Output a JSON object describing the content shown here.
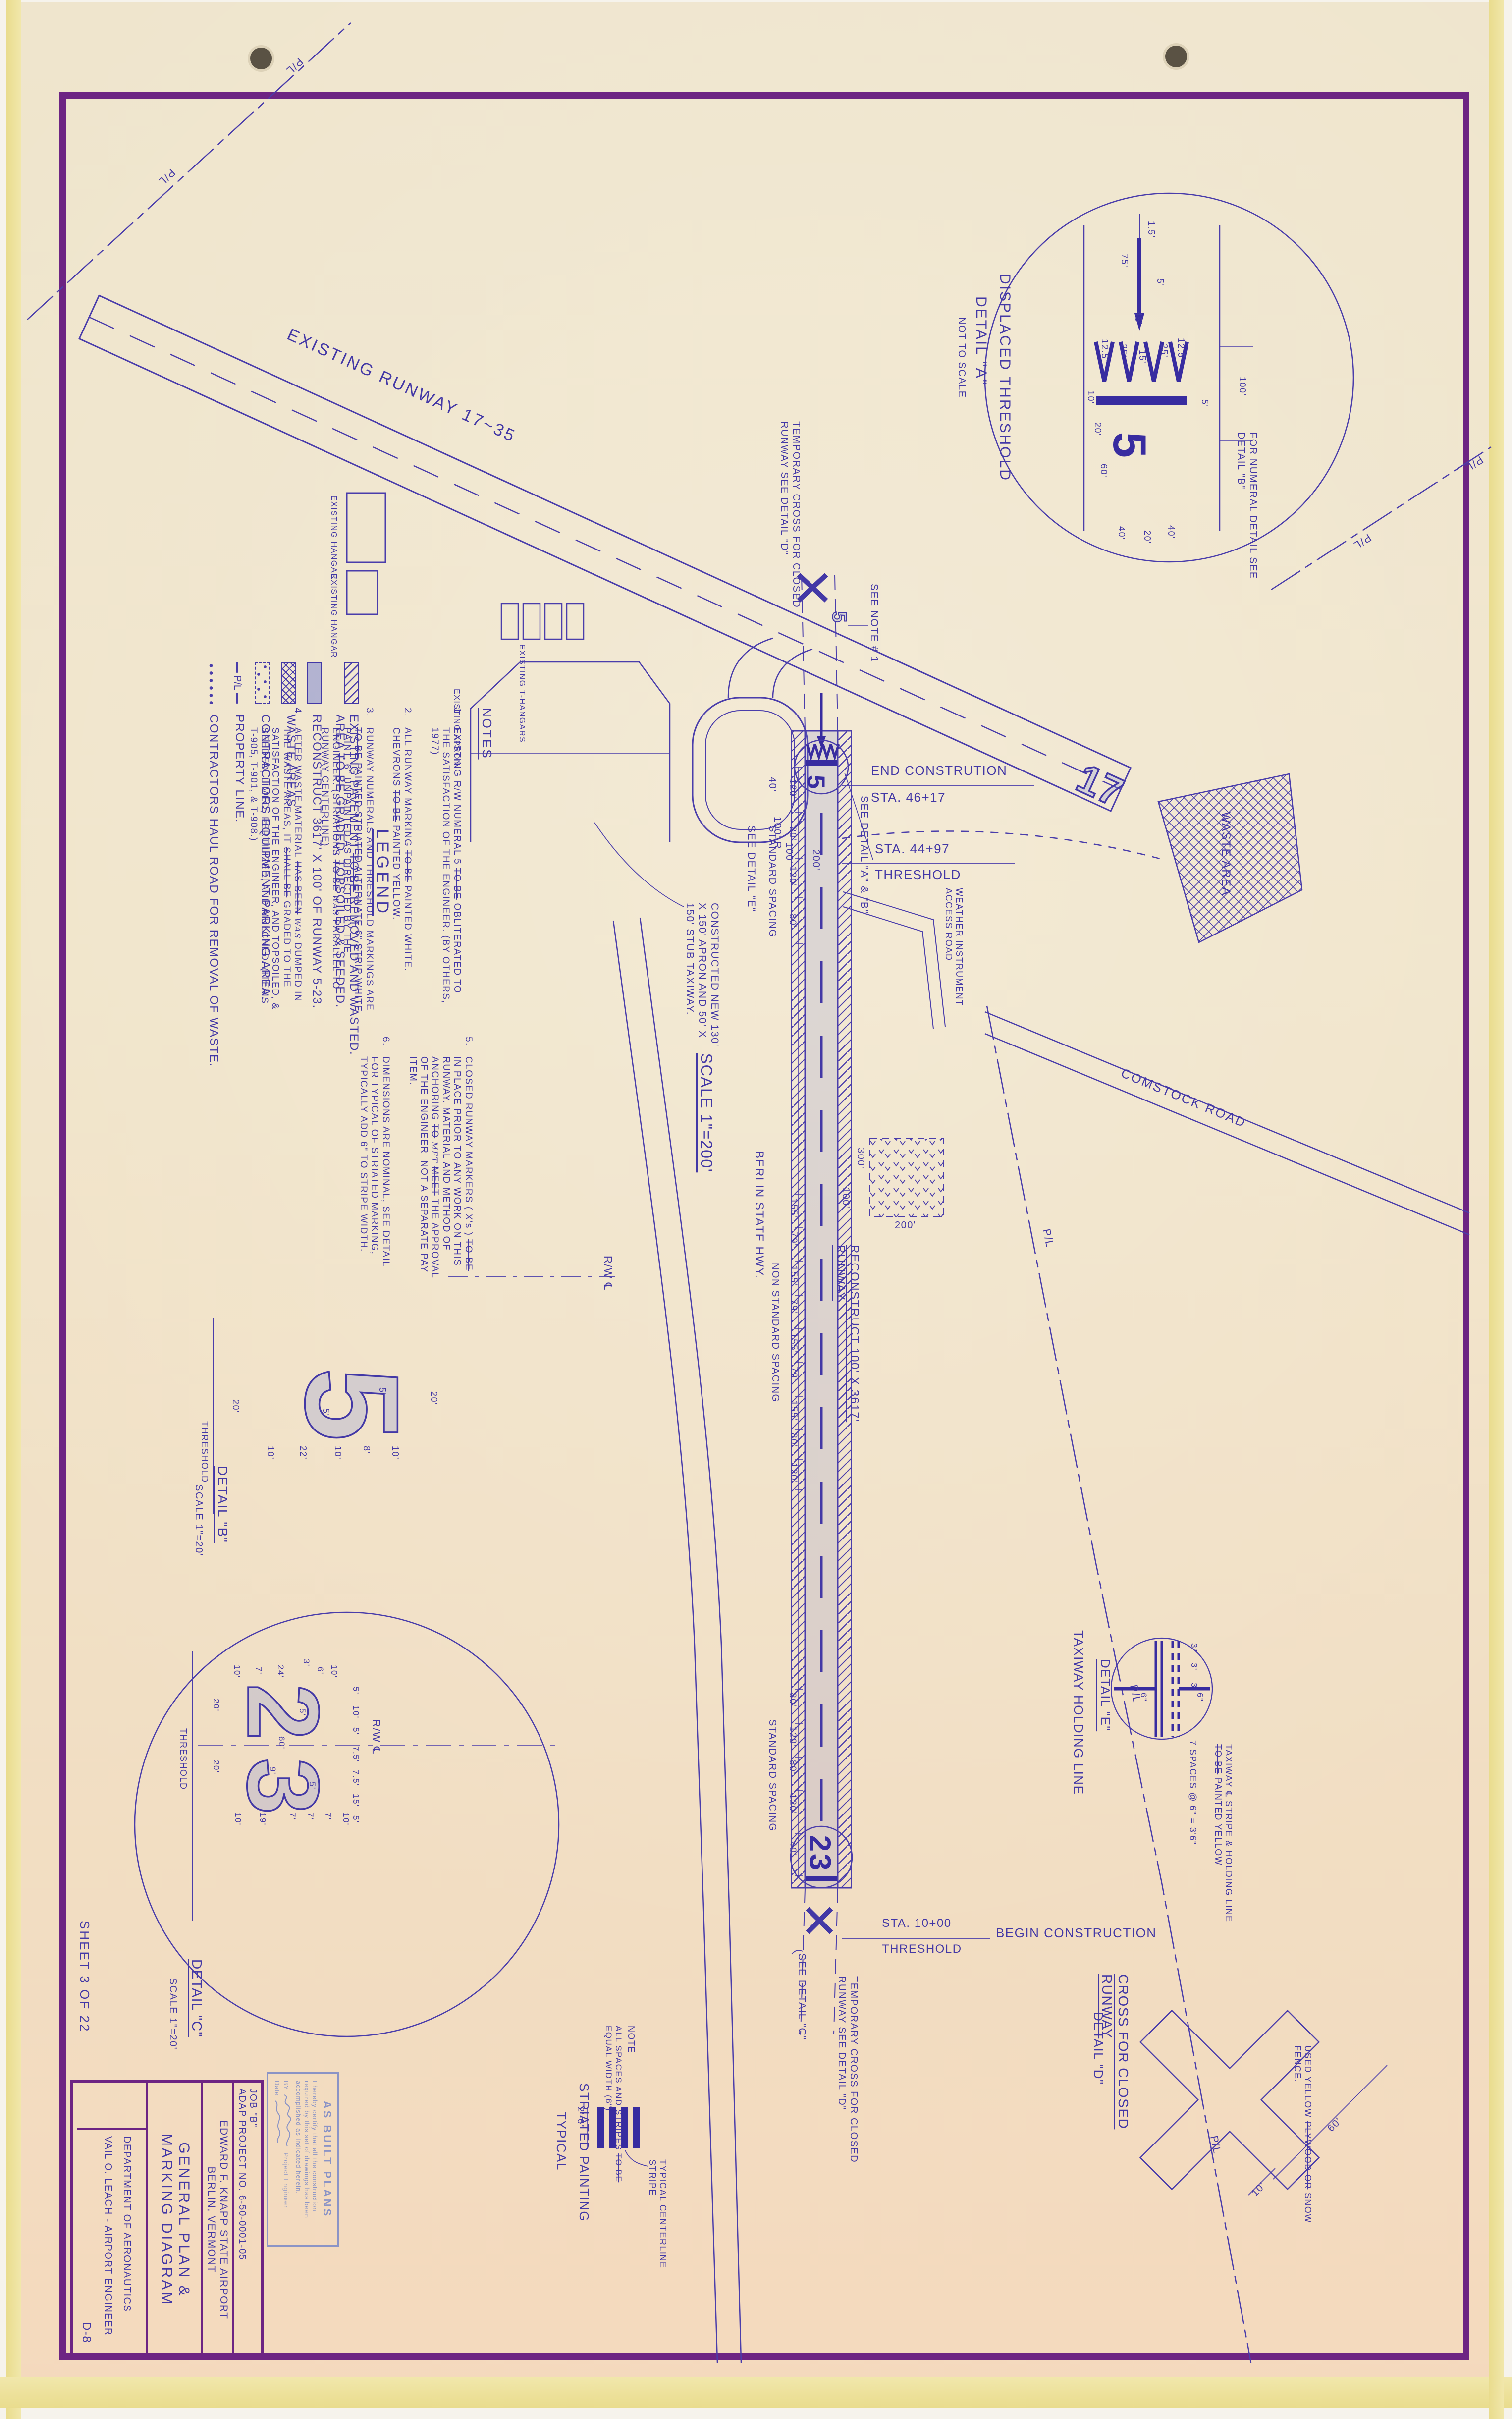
{
  "colors": {
    "ink": "#4338a6",
    "ink_dark": "#382ca0",
    "frame": "#6d2483",
    "paper": "#f0e4c9",
    "stamp_blue": "#8b94c6",
    "runway_fill": "rgba(115,128,210,0.2)"
  },
  "sheet": {
    "sheet_label": "SHEET 3 OF 22",
    "drawing_no": "D-8"
  },
  "title_block": {
    "job_line1": "JOB \"B\"",
    "job_line2": "ADAP PROJECT NO. 6-50-0001-05",
    "airport": "EDWARD F. KNAPP STATE AIRPORT",
    "city": "BERLIN, VERMONT",
    "title_line1": "GENERAL PLAN &",
    "title_line2": "MARKING DIAGRAM",
    "department": "DEPARTMENT OF AERONAUTICS",
    "engineer": "VAIL O. LEACH - AIRPORT ENGINEER"
  },
  "stamp": {
    "title": "AS BUILT PLANS",
    "body": "I hereby certify that all the construction required by this set of drawings has been accomplished as indicated herein.",
    "by_label": "BY",
    "engineer_label": "Project Engineer",
    "date_label": "Date"
  },
  "legend": {
    "title": "LEGEND",
    "items": [
      {
        "swatch": "hatch",
        "label": "EXISTING PAVEMENT ~~TO BE~~ REMOVED AND WASTED. AREA ~~TO BE~~ GRADED, TOPSOILED & SEEDED."
      },
      {
        "swatch": "solid",
        "label": "RECONSTRUCT 3617' X 100' OF RUNWAY 5-23."
      },
      {
        "swatch": "cross",
        "label": "WASTE AREAS"
      },
      {
        "swatch": "vees",
        "label": "CONTRACTORS EQUIPMENT PARKING AREA."
      },
      {
        "swatch": "pl",
        "swatch_text": "P/L",
        "label": "PROPERTY LINE."
      },
      {
        "swatch": "dots",
        "label": "CONTRACTORS HAUL ROAD FOR REMOVAL OF WASTE."
      }
    ]
  },
  "notes": {
    "title": "NOTES",
    "items": [
      {
        "no": "1.",
        "text": "EXISTING R/W NUMERAL 5 ~~TO BE~~ OBLITERATED TO THE SATISFACTION OF THE ENGINEER. (BY OTHERS, 1977)"
      },
      {
        "no": "2.",
        "text": "ALL RUNWAY MARKING ~~TO BE~~ PAINTED WHITE. CHEVRONS ~~TO BE~~ PAINTED YELLOW."
      },
      {
        "no": "3.",
        "text": "RUNWAY NUMERALS AND THRESHOLD MARKINGS ARE ~~TO BE~~ PAINTED STRIATED ALTERNATE 6\" STRIP WHITE PAINT, 6\" UNPAINTED AS DIRECTED BY THE ENGINEER. (STRIATIONS ~~TO BE~~ ^^WAS^^ PARALLEL TO RUNWAY CENTERLINE)"
      },
      {
        "no": "4.",
        "text": "AFTER WASTE MATERIAL ~~HAS BEEN~~ ^^WAS^^ DUMPED IN THE WASTE AREAS, IT ~~SHALL BE~~ GRADED TO THE SATISFACTION OF THE ENGINEER, AND TOPSOILED, & SEEDED, LIMED, FERTILIZED, AND MULCHED. (ITEMS T-905, T-901, & T-908.)"
      },
      {
        "no": "5.",
        "text": "CLOSED RUNWAY MARKERS ( X's ) ~~TO BE~~ IN PLACE PRIOR TO ANY WORK ON THIS RUNWAY. MATERIAL AND METHOD OF ANCHORING ~~TO~~ ^^MET^^ ~~MEET~~ THE APPROVAL OF THE ENGINEER. NOT A SEPARATE PAY ITEM."
      },
      {
        "no": "6.",
        "text": "DIMENSIONS ARE NOMINAL, SEE DETAIL FOR TYPICAL OF STRIATED MARKING, TYPICALLY ADD 6\" TO STRIPE WIDTH."
      }
    ]
  },
  "plan": {
    "existing_runway_label": "EXISTING RUNWAY 17~35",
    "numeral_17": "17",
    "numeral_5": "5",
    "numeral_23": "23",
    "pl": "P/L",
    "see_note_1": "SEE NOTE # 1",
    "temp_cross_note": "TEMPORARY CROSS FOR CLOSED RUNWAY SEE DETAIL \"D\"",
    "end_construction": "END CONSTRUTION",
    "sta_46_17": "STA. 46+17",
    "sta_44_97": "STA. 44+97",
    "threshold": "THRESHOLD",
    "sta_10_00": "STA. 10+00",
    "begin_construction": "BEGIN CONSTRUCTION",
    "see_detail_ab": "SEE DETAIL \"A\" & \"B\"",
    "see_detail_c": "SEE DETAIL \"C\"",
    "see_detail_e": "SEE DETAIL \"E\"",
    "reconstruct_runway": "RECONSTRUCT 100' X 3617' RUNWAY",
    "constructed_apron": "CONSTRUCTED NEW 130' X 150' APRON AND 50' X 150' STUB TAXIWAY.",
    "berlin_hwy": "BERLIN STATE HWY.",
    "comstock_road": "COMSTOCK ROAD",
    "weather_road": "WEATHER INSTRUMENT ACCESS ROAD",
    "waste_area": "WASTE AREA",
    "standard_spacing": "STANDARD SPACING",
    "non_standard_spacing": "NON STANDARD SPACING",
    "scale_200": "SCALE 1\"=200'",
    "existing_hangar": "EXISTING HANGAR",
    "existing_apron": "EXISTING APRON",
    "existing_t_hangars": "EXISTING T-HANGARS",
    "rw_cl": "R/W ℄",
    "dim_40": "40'",
    "dim_100": "100'",
    "dim_200": "200'",
    "dim_100r": "100' R",
    "dim_300": "300'",
    "spacing_top": [
      "120'",
      "80'",
      "120'",
      "80'"
    ],
    "spacing_mid": [
      "155'",
      "79'",
      "155'",
      "79'",
      "155'",
      "79'",
      "155'",
      "80'",
      "120'"
    ],
    "spacing_bot": [
      "80'",
      "120'",
      "80'",
      "120'",
      "40'"
    ]
  },
  "details": {
    "a": {
      "title": "DISPLACED THRESHOLD",
      "subtitle": "DETAIL \"A\"",
      "scale_note": "NOT TO SCALE",
      "numeral": "5",
      "note": "FOR NUMERAL DETAIL SEE DETAIL \"B\"",
      "dims": [
        "1.5'",
        "75'",
        "5'",
        "45'",
        "12.5'",
        "25'",
        "15'",
        "25'",
        "12.5'",
        "100'",
        "5'",
        "10'",
        "20'",
        "60'",
        "40'",
        "20'",
        "40'"
      ]
    },
    "b": {
      "title": "DETAIL \"B\"",
      "scale": "SCALE 1\"=20'",
      "numeral": "5",
      "dims": [
        "20'",
        "5'",
        "5'",
        "20'",
        "10'",
        "22'",
        "10'",
        "8'",
        "10'"
      ]
    },
    "c": {
      "title": "DETAIL \"C\"",
      "scale": "SCALE 1\"=20'",
      "numeral_2": "2",
      "numeral_3": "3",
      "dims": [
        "10'",
        "7'",
        "24'",
        "3'",
        "6'",
        "10'",
        "5'",
        "10'",
        "5'",
        "7.5'",
        "7.5'",
        "15'",
        "5'",
        "20'",
        "20'",
        "60'",
        "9'",
        "5'",
        "5'",
        "10'",
        "19'",
        "7'",
        "7'",
        "7'",
        "10'"
      ]
    },
    "d": {
      "title": "CROSS FOR CLOSED RUNWAY",
      "subtitle": "DETAIL \"D\"",
      "note": "USED YELLOW ~~PLYWOOD OR~~ SNOW FENCE.",
      "dim_10": "10'",
      "dim_60": "60'"
    },
    "e": {
      "title": "TAXIWAY HOLDING LINE",
      "subtitle": "DETAIL \"E\"",
      "spaces_note": "7 SPACES @ 6\" = 3'6\"",
      "paint_note": "TAXIWAY ℄ STRIPE & HOLDING LINE ~~TO BE~~ PAINTED YELLOW",
      "dims": [
        "3\"",
        "3'",
        "3'",
        "6\"",
        "6\""
      ]
    },
    "striated": {
      "note_title": "NOTE",
      "note_text": "ALL SPACES AND STRIPES ~~TO BE~~ EQUAL WIDTH (6\")",
      "dim": "2'-6\"",
      "stripe_label": "TYPICAL CENTERLINE STRIPE",
      "title1": "STRIATED PAINTING",
      "title2": "TYPICAL"
    }
  }
}
